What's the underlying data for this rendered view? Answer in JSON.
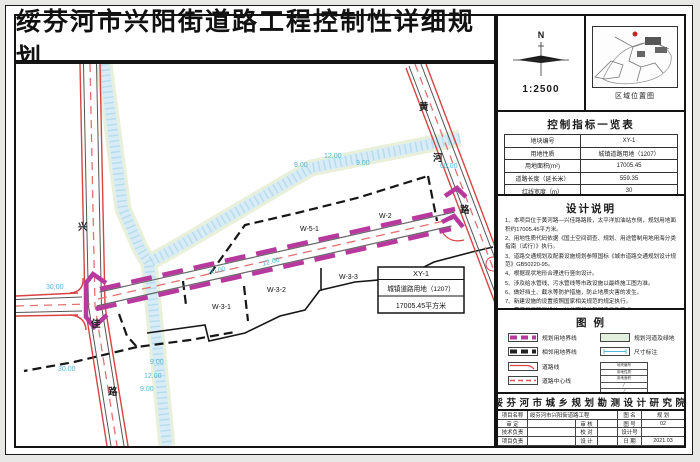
{
  "title": "绥芬河市兴阳街道路工程控制性详细规划",
  "compass": {
    "north": "N",
    "scale": "1:2500"
  },
  "location_map": {
    "caption": "区域位置图"
  },
  "indicator_table": {
    "title": "控制指标一览表",
    "rows": [
      {
        "label": "地块编号",
        "value": "XY-1"
      },
      {
        "label": "用地性质",
        "value": "城镇道路用地（1207）"
      },
      {
        "label": "用地面积(m²)",
        "value": "17005.45"
      },
      {
        "label": "道路长度（延长米）",
        "value": "559.35"
      },
      {
        "label": "红线宽度（m）",
        "value": "30"
      }
    ]
  },
  "design_notes": {
    "title": "设计说明",
    "items": [
      "1、本项目位于黄河路—兴佳路路段，太平洋加油站东侧，规划用地面积约17005.45平方米。",
      "2、用地性质代码依据《国土空间调查、规划、用途管制用地用海分类指南（试行）》执行。",
      "3、道路交通规划及配套设施规划参照国标《城市道路交通规划设计规范》GB50220-95。",
      "4、根据现状地形合理进行竖向设计。",
      "5、涉及给水管线、污水管线等市政设施以最终施工图为准。",
      "6、做好挡土、截水等防护措施，防止地质灾害的发生。",
      "7、新建设施的设置按照国家相关规范的规定执行。",
      "8、需满足无障碍设计，并参照相关部门意见及要求。",
      "9、图示尺寸以米为单位。"
    ]
  },
  "legend": {
    "title": "图  例",
    "items_left": [
      {
        "label": "规划用地界线"
      },
      {
        "label": "相邻用地界线"
      },
      {
        "label": "道路线"
      },
      {
        "label": "道路中心线"
      }
    ],
    "items_right": [
      {
        "label": "规划河道及绿地"
      },
      {
        "label": "尺寸标注"
      }
    ],
    "mini_table": {
      "rows": [
        "地块编号",
        "用地性质",
        "用地面积"
      ],
      "slash": "╱"
    }
  },
  "title_block": {
    "institute": "绥芬河市城乡规划勘测设计研究院",
    "fields": {
      "project_label": "项目名称",
      "project_value": "绥芬河市兴阳街道路工程",
      "sheet_name_label": "图 名",
      "sheet_name_value": "规 划",
      "approve_label": "审 定",
      "review_label": "审 核",
      "sheet_no_label": "图 号",
      "sheet_no_value": "02",
      "tech_label": "技术负责",
      "proof_label": "校 对",
      "design_no_label": "设计号",
      "design_no_value": "",
      "lead_label": "项目负责",
      "design_label": "设 计",
      "date_label": "日 期",
      "date_value": "2021.03"
    }
  },
  "map": {
    "roads": {
      "xingjia_1": "兴",
      "xingjia_2": "佳",
      "xingjia_3": "路",
      "huanghe_1": "黄",
      "huanghe_2": "河",
      "huanghe_3": "路"
    },
    "plots": {
      "w2": "W-2",
      "w51": "W-5-1",
      "w31": "W-3-1",
      "w32": "W-3-2",
      "w33": "W-3-3"
    },
    "dims": {
      "d1": "30.00",
      "d2": "30.00",
      "d3": "9.00",
      "d4": "12.00",
      "d5": "9.00",
      "d6": "9.00",
      "d7": "12.00",
      "d8": "9.00",
      "d9": "60.00",
      "d10": "30.00",
      "d11": "12.00"
    },
    "callout": {
      "code": "XY-1",
      "use": "城镇道路用地（1207）",
      "area": "17005.45平方米"
    }
  },
  "colors": {
    "boundary_magenta": "#b8399e",
    "road_red": "#d84343",
    "centerline_red": "#e37070",
    "dim_cyan": "#56b8d8",
    "green_area": "#e2efdc",
    "stream_blue": "#d7ecf6"
  }
}
